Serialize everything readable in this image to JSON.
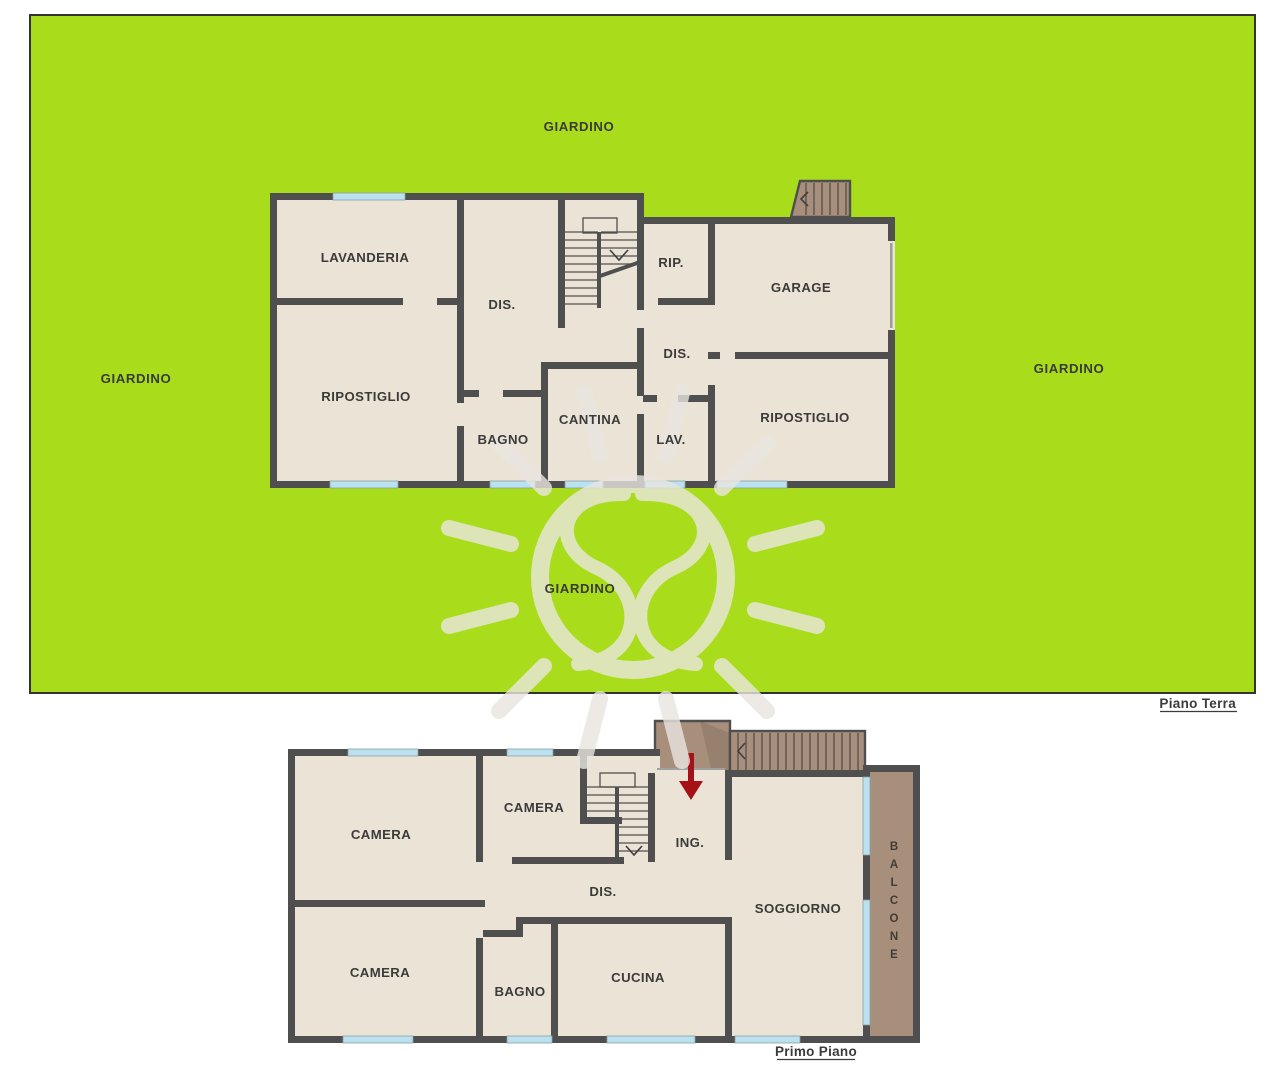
{
  "colors": {
    "background": "#ffffff",
    "garden_green": "#a9dd1c",
    "garden_border": "#333333",
    "wall_gray": "#4f4f4f",
    "floor_beige": "#ebe4d6",
    "window_blue": "#bae1ef",
    "terrace_brown": "#a88f7c",
    "terrace_shadow": "#96806e",
    "arrow_red": "#a41217",
    "label_gray": "#3b3b3b",
    "watermark": "#e9e6e0"
  },
  "garden": {
    "label_top": "GIARDINO",
    "label_left": "GIARDINO",
    "label_right": "GIARDINO",
    "label_bottom": "GIARDINO"
  },
  "ground_floor": {
    "title": "Piano Terra",
    "rooms": {
      "lavanderia": "LAVANDERIA",
      "dis_center": "DIS.",
      "rip": "RIP.",
      "garage": "GARAGE",
      "ripostiglio_left": "RIPOSTIGLIO",
      "bagno": "BAGNO",
      "cantina": "CANTINA",
      "dis_right": "DIS.",
      "lav": "LAV.",
      "ripostiglio_right": "RIPOSTIGLIO"
    }
  },
  "first_floor": {
    "title": "Primo Piano",
    "rooms": {
      "camera_top_left": "CAMERA",
      "camera_top_middle": "CAMERA",
      "ing": "ING.",
      "dis": "DIS.",
      "camera_bottom_left": "CAMERA",
      "bagno": "BAGNO",
      "cucina": "CUCINA",
      "soggiorno": "SOGGIORNO",
      "balcone": "BALCONE"
    }
  }
}
